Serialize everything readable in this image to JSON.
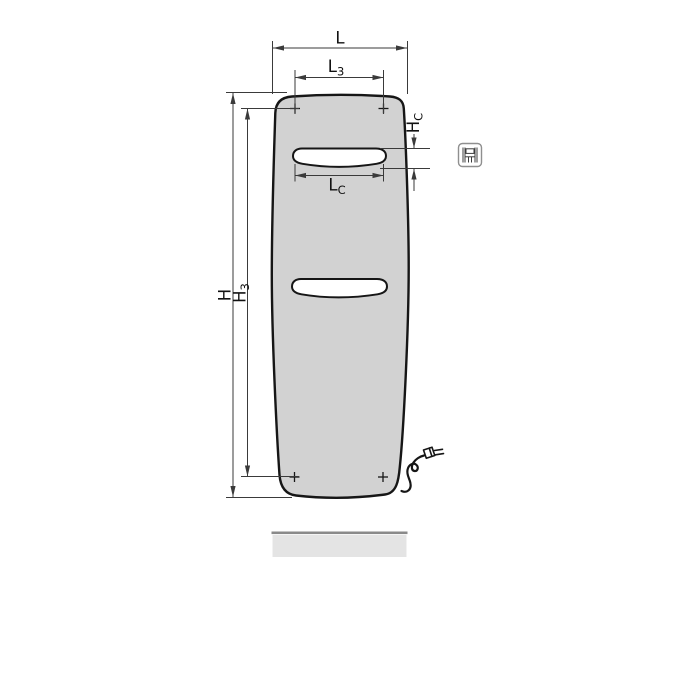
{
  "diagram": {
    "kind": "technical-dimension-drawing",
    "subject": "panel radiator front view with power cable and plug"
  },
  "labels": {
    "width_overall": {
      "base": "L",
      "sub": ""
    },
    "fixing_width": {
      "base": "L",
      "sub": "3"
    },
    "height_overall": {
      "base": "H",
      "sub": ""
    },
    "fixing_height": {
      "base": "H",
      "sub": "3"
    },
    "cutout_height": {
      "base": "H",
      "sub": "C"
    },
    "cutout_width": {
      "base": "L",
      "sub": "C"
    }
  },
  "icons": {
    "variant_icon": "radiator-front-pictogram"
  },
  "colors": {
    "background": "#ffffff",
    "panel_fill": "#d2d2d2",
    "outline": "#161616",
    "dimension_line": "#3a3a3a",
    "slot_fill": "#ffffff",
    "baseboard_fill": "#e4e4e4",
    "baseboard_edge": "#8a8a8a",
    "icon_border": "#8f8f8f",
    "icon_glyph": "#3c3c3c"
  }
}
